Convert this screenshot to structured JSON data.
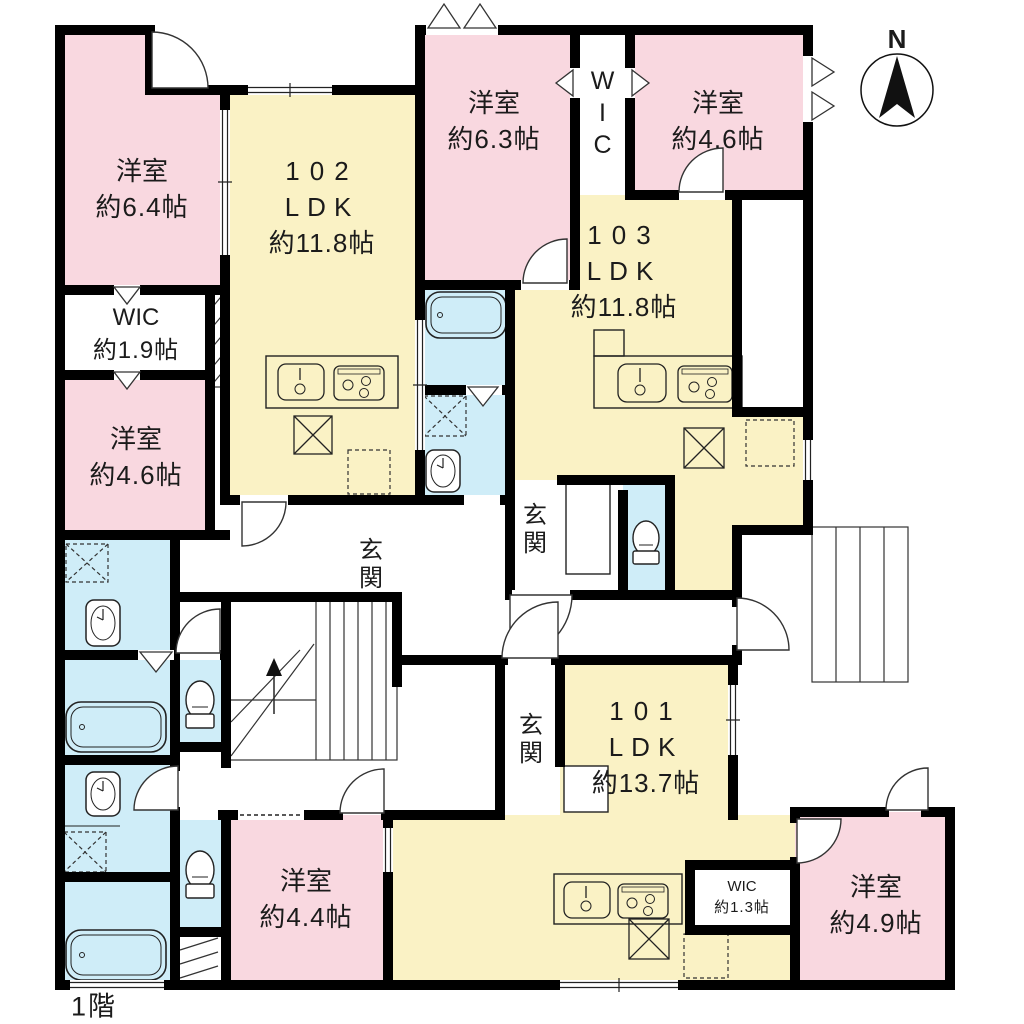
{
  "floor_label": "1階",
  "compass": {
    "north": "N"
  },
  "colors": {
    "bedroom_pink": "#F9D8E0",
    "ldk_yellow": "#FAF2C5",
    "wet_area_blue": "#CFEDF8",
    "wall_black": "#000000"
  },
  "units": {
    "u102": {
      "number": "102",
      "type": "LDK",
      "size": "約11.8帖"
    },
    "u103": {
      "number": "103",
      "type": "LDK",
      "size": "約11.8帖"
    },
    "u101": {
      "number": "101",
      "type": "LDK",
      "size": "約13.7帖"
    }
  },
  "rooms": {
    "bed64": {
      "name": "洋室",
      "size": "約6.4帖"
    },
    "bed63": {
      "name": "洋室",
      "size": "約6.3帖"
    },
    "bed46r": {
      "name": "洋室",
      "size": "約4.6帖"
    },
    "bed46l": {
      "name": "洋室",
      "size": "約4.6帖"
    },
    "bed44": {
      "name": "洋室",
      "size": "約4.4帖"
    },
    "bed49": {
      "name": "洋室",
      "size": "約4.9帖"
    },
    "wic_north": {
      "name": "WIC"
    },
    "wic19": {
      "name": "WIC",
      "size": "約1.9帖"
    },
    "wic13": {
      "name": "WIC",
      "size": "約1.3帖"
    }
  },
  "entrances": {
    "genkan102": "玄関",
    "genkan103": "玄関",
    "genkan101": "玄関"
  },
  "icons": {
    "bathtub-icon": "unit bathtub",
    "toilet-icon": "toilet",
    "washbasin-icon": "wash basin",
    "kitchen-sink-icon": "kitchen sink",
    "gas-stove-icon": "gas stove",
    "refrigerator-space-icon": "refrigerator space (crossed box)",
    "laundry-space-icon": "washer space (dashed box)",
    "staircase-icon": "internal staircase (up)",
    "external-stairs-icon": "external staircase",
    "compass-icon": "north arrow compass"
  }
}
